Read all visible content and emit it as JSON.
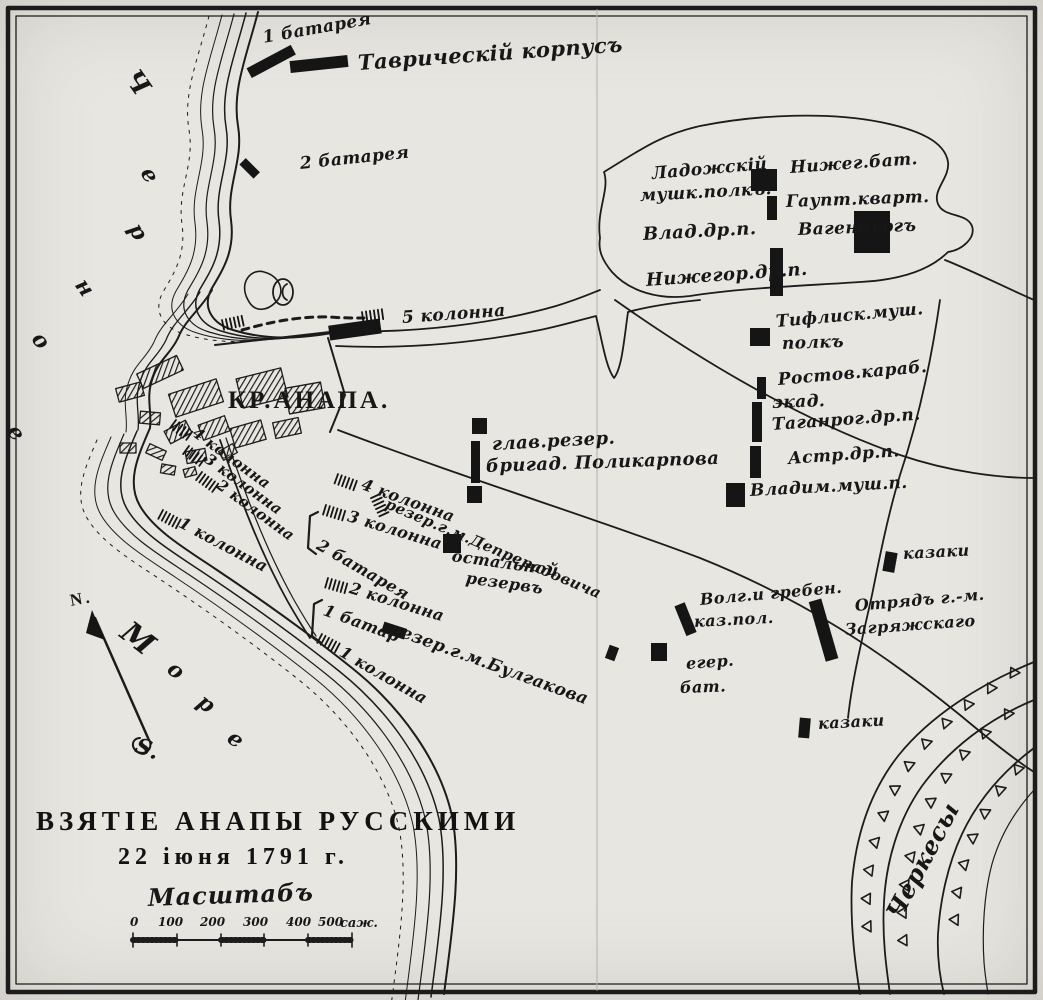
{
  "map": {
    "title_line1": "ВЗЯТІЕ  АНАПЫ  РУССКИМИ",
    "title_line2": "22 іюня  1791 г.",
    "paper_color": "#e8e6e1",
    "ink_color": "#1c1c1c",
    "scale_unit": "саж.",
    "labels": [
      {
        "name": "battery-1-label",
        "text": "1 батарея",
        "x": 263,
        "y": 30,
        "r": -10,
        "cls": "hand",
        "fs": 17
      },
      {
        "name": "tavrichesky-corps-label",
        "text": "Таврическій корпусъ",
        "x": 358,
        "y": 52,
        "r": -4,
        "cls": "hand",
        "fs": 21
      },
      {
        "name": "battery-2-label",
        "text": "2 батарея",
        "x": 300,
        "y": 156,
        "r": -6,
        "cls": "hand",
        "fs": 17
      },
      {
        "name": "ladoga-regiment-label-1",
        "text": "Ладожскій",
        "x": 652,
        "y": 166,
        "r": -5,
        "cls": "hand",
        "fs": 17
      },
      {
        "name": "ladoga-regiment-label-2",
        "text": "мушк.полкъ.",
        "x": 640,
        "y": 188,
        "r": -3,
        "cls": "hand",
        "fs": 17
      },
      {
        "name": "nizhny-battalion-label",
        "text": "Нижег.бат.",
        "x": 790,
        "y": 160,
        "r": -4,
        "cls": "hand",
        "fs": 17
      },
      {
        "name": "headquarters-label",
        "text": "Гаупт.кварт.",
        "x": 786,
        "y": 194,
        "r": -2,
        "cls": "hand",
        "fs": 17
      },
      {
        "name": "vladimir-dragoons-label",
        "text": "Влад.др.п.",
        "x": 643,
        "y": 226,
        "r": -3,
        "cls": "hand",
        "fs": 18
      },
      {
        "name": "wagenburg-label",
        "text": "Вагенбургъ",
        "x": 798,
        "y": 222,
        "r": -2,
        "cls": "hand",
        "fs": 17
      },
      {
        "name": "nizhegorod-dragoons-label",
        "text": "Нижегор.др.п.",
        "x": 646,
        "y": 272,
        "r": -4,
        "cls": "hand",
        "fs": 18
      },
      {
        "name": "tiflis-regiment-label-1",
        "text": "Тифлиск.муш.",
        "x": 776,
        "y": 314,
        "r": -5,
        "cls": "hand",
        "fs": 17
      },
      {
        "name": "tiflis-regiment-label-2",
        "text": "полкъ",
        "x": 782,
        "y": 336,
        "r": -2,
        "cls": "hand",
        "fs": 17
      },
      {
        "name": "rostov-carabineers-label-1",
        "text": "Ростов.караб.",
        "x": 778,
        "y": 372,
        "r": -5,
        "cls": "hand",
        "fs": 17
      },
      {
        "name": "rostov-carabineers-label-2",
        "text": "экад.",
        "x": 772,
        "y": 395,
        "r": -2,
        "cls": "hand",
        "fs": 17
      },
      {
        "name": "taganrog-dragoons-label",
        "text": "Таганрог.др.п.",
        "x": 772,
        "y": 417,
        "r": -4,
        "cls": "hand",
        "fs": 17
      },
      {
        "name": "astrakhan-dragoons-label",
        "text": "Астр.др.п.",
        "x": 788,
        "y": 451,
        "r": -4,
        "cls": "hand",
        "fs": 17
      },
      {
        "name": "vladimir-musketeers-label",
        "text": "Владим.муш.п.",
        "x": 750,
        "y": 483,
        "r": -3,
        "cls": "hand",
        "fs": 17
      },
      {
        "name": "column-5-label",
        "text": "5 колонна",
        "x": 402,
        "y": 310,
        "r": -4,
        "cls": "hand",
        "fs": 17
      },
      {
        "name": "fortress-anapa-label",
        "text": "КР.АНАПА.",
        "x": 228,
        "y": 388,
        "r": 0,
        "cls": "caps",
        "fs": 25
      },
      {
        "name": "column-4-fortress-label",
        "text": "4 колонна",
        "x": 194,
        "y": 424,
        "r": 36,
        "cls": "hand",
        "fs": 15
      },
      {
        "name": "column-3-fortress-label",
        "text": "3 колонна",
        "x": 206,
        "y": 450,
        "r": 36,
        "cls": "hand",
        "fs": 15
      },
      {
        "name": "column-2-fortress-label",
        "text": "2 колонна",
        "x": 218,
        "y": 476,
        "r": 36,
        "cls": "hand",
        "fs": 15
      },
      {
        "name": "column-1-fortress-label",
        "text": "1 колонна",
        "x": 180,
        "y": 514,
        "r": 28,
        "cls": "hand",
        "fs": 16
      },
      {
        "name": "main-reserve-label-1",
        "text": "глав.резер.",
        "x": 492,
        "y": 436,
        "r": -3,
        "cls": "hand",
        "fs": 18
      },
      {
        "name": "main-reserve-label-2",
        "text": "бригад. Поликарпова",
        "x": 486,
        "y": 458,
        "r": -2,
        "cls": "hand",
        "fs": 18
      },
      {
        "name": "column-4-camp-label",
        "text": "4 колонна",
        "x": 362,
        "y": 476,
        "r": 20,
        "cls": "hand",
        "fs": 16
      },
      {
        "name": "deprerado-reserve-label",
        "text": "резер.г.м.Депрерадовича",
        "x": 386,
        "y": 496,
        "r": 23,
        "cls": "hand",
        "fs": 15
      },
      {
        "name": "column-3-camp-label",
        "text": "3 колонна",
        "x": 348,
        "y": 508,
        "r": 17,
        "cls": "hand",
        "fs": 16
      },
      {
        "name": "rear-reserve-label-1",
        "text": "остальной",
        "x": 452,
        "y": 548,
        "r": 8,
        "cls": "hand",
        "fs": 16
      },
      {
        "name": "rear-reserve-label-2",
        "text": "резервъ",
        "x": 466,
        "y": 570,
        "r": 8,
        "cls": "hand",
        "fs": 16
      },
      {
        "name": "battery-2-camp-label",
        "text": "2 батарея",
        "x": 318,
        "y": 536,
        "r": 30,
        "cls": "hand",
        "fs": 16
      },
      {
        "name": "column-2-camp-label",
        "text": "2 колонна",
        "x": 350,
        "y": 580,
        "r": 17,
        "cls": "hand",
        "fs": 16
      },
      {
        "name": "battery-1-camp-label",
        "text": "1 батар",
        "x": 324,
        "y": 602,
        "r": 20,
        "cls": "hand",
        "fs": 16
      },
      {
        "name": "bulgakov-reserve-label",
        "text": "резер.г.м.Булгакова",
        "x": 390,
        "y": 620,
        "r": 20,
        "cls": "hand",
        "fs": 17
      },
      {
        "name": "column-1-camp-label",
        "text": "1 колонна",
        "x": 341,
        "y": 643,
        "r": 30,
        "cls": "hand",
        "fs": 16
      },
      {
        "name": "volga-cossacks-label-1",
        "text": "Волг.и гребен.",
        "x": 700,
        "y": 592,
        "r": -5,
        "cls": "hand",
        "fs": 16
      },
      {
        "name": "volga-cossacks-label-2",
        "text": "каз.пол.",
        "x": 694,
        "y": 614,
        "r": -3,
        "cls": "hand",
        "fs": 16
      },
      {
        "name": "zagryazhsky-label-1",
        "text": "Отрядъ г.-м.",
        "x": 855,
        "y": 598,
        "r": -5,
        "cls": "hand",
        "fs": 16
      },
      {
        "name": "zagryazhsky-label-2",
        "text": "Загряжскаго",
        "x": 845,
        "y": 622,
        "r": -4,
        "cls": "hand",
        "fs": 16
      },
      {
        "name": "jager-battalion-label-1",
        "text": "егер.",
        "x": 686,
        "y": 656,
        "r": -4,
        "cls": "hand",
        "fs": 16
      },
      {
        "name": "jager-battalion-label-2",
        "text": "бат.",
        "x": 680,
        "y": 680,
        "r": -2,
        "cls": "hand",
        "fs": 16
      },
      {
        "name": "cossacks-upper-label",
        "text": "казаки",
        "x": 903,
        "y": 546,
        "r": -3,
        "cls": "hand",
        "fs": 16
      },
      {
        "name": "cossacks-lower-label",
        "text": "казаки",
        "x": 818,
        "y": 716,
        "r": -3,
        "cls": "hand",
        "fs": 16
      },
      {
        "name": "circassians-label",
        "text": "Черкесы",
        "x": 893,
        "y": 905,
        "r": -62,
        "cls": "hand",
        "fs": 24
      },
      {
        "name": "map-title-line1",
        "text": "ВЗЯТІЕ  АНАПЫ  РУССКИМИ",
        "x": 36,
        "y": 808,
        "r": 0,
        "cls": "title",
        "fs": 27
      },
      {
        "name": "map-title-line2",
        "text": "22 іюня  1791 г.",
        "x": 118,
        "y": 845,
        "r": 0,
        "cls": "title",
        "fs": 24
      },
      {
        "name": "scale-title",
        "text": "Масштабъ",
        "x": 148,
        "y": 886,
        "r": -2,
        "cls": "script",
        "fs": 24
      },
      {
        "name": "scale-tick-0",
        "text": "0",
        "x": 130,
        "y": 916,
        "r": 0,
        "cls": "num",
        "fs": 12
      },
      {
        "name": "scale-tick-100",
        "text": "100",
        "x": 158,
        "y": 916,
        "r": 0,
        "cls": "num",
        "fs": 12
      },
      {
        "name": "scale-tick-200",
        "text": "200",
        "x": 200,
        "y": 916,
        "r": 0,
        "cls": "num",
        "fs": 12
      },
      {
        "name": "scale-tick-300",
        "text": "300",
        "x": 243,
        "y": 916,
        "r": 0,
        "cls": "num",
        "fs": 12
      },
      {
        "name": "scale-tick-400",
        "text": "400",
        "x": 286,
        "y": 916,
        "r": 0,
        "cls": "num",
        "fs": 12
      },
      {
        "name": "scale-tick-500",
        "text": "500",
        "x": 318,
        "y": 916,
        "r": 0,
        "cls": "num",
        "fs": 12
      },
      {
        "name": "scale-unit-label",
        "text": "саж.",
        "x": 340,
        "y": 917,
        "r": 0,
        "cls": "num",
        "fs": 13
      },
      {
        "name": "compass-north-label",
        "text": "N.",
        "x": 70,
        "y": 592,
        "r": -10,
        "cls": "caps",
        "fs": 17
      },
      {
        "name": "compass-south-label",
        "text": "S.",
        "x": 136,
        "y": 734,
        "r": 20,
        "cls": "script",
        "fs": 22
      },
      {
        "name": "sea-letter-1",
        "text": "М",
        "x": 124,
        "y": 614,
        "r": 38,
        "cls": "script",
        "fs": 30
      },
      {
        "name": "sea-letter-2",
        "text": "о",
        "x": 170,
        "y": 655,
        "r": 38,
        "cls": "script",
        "fs": 22
      },
      {
        "name": "sea-letter-3",
        "text": "р",
        "x": 200,
        "y": 688,
        "r": 38,
        "cls": "script",
        "fs": 22
      },
      {
        "name": "sea-letter-4",
        "text": "е",
        "x": 230,
        "y": 724,
        "r": 38,
        "cls": "script",
        "fs": 22
      },
      {
        "name": "blacksea-letter-1",
        "text": "Ч",
        "x": 130,
        "y": 60,
        "r": 55,
        "cls": "script",
        "fs": 26
      },
      {
        "name": "blacksea-letter-2",
        "text": "е",
        "x": 146,
        "y": 158,
        "r": 60,
        "cls": "script",
        "fs": 22
      },
      {
        "name": "blacksea-letter-3",
        "text": "р",
        "x": 134,
        "y": 214,
        "r": 60,
        "cls": "script",
        "fs": 22
      },
      {
        "name": "blacksea-letter-4",
        "text": "н",
        "x": 80,
        "y": 270,
        "r": 55,
        "cls": "script",
        "fs": 22
      },
      {
        "name": "blacksea-letter-5",
        "text": "о",
        "x": 36,
        "y": 324,
        "r": 50,
        "cls": "script",
        "fs": 22
      },
      {
        "name": "blacksea-letter-6",
        "text": "е",
        "x": 12,
        "y": 416,
        "r": 55,
        "cls": "script",
        "fs": 22
      }
    ]
  }
}
